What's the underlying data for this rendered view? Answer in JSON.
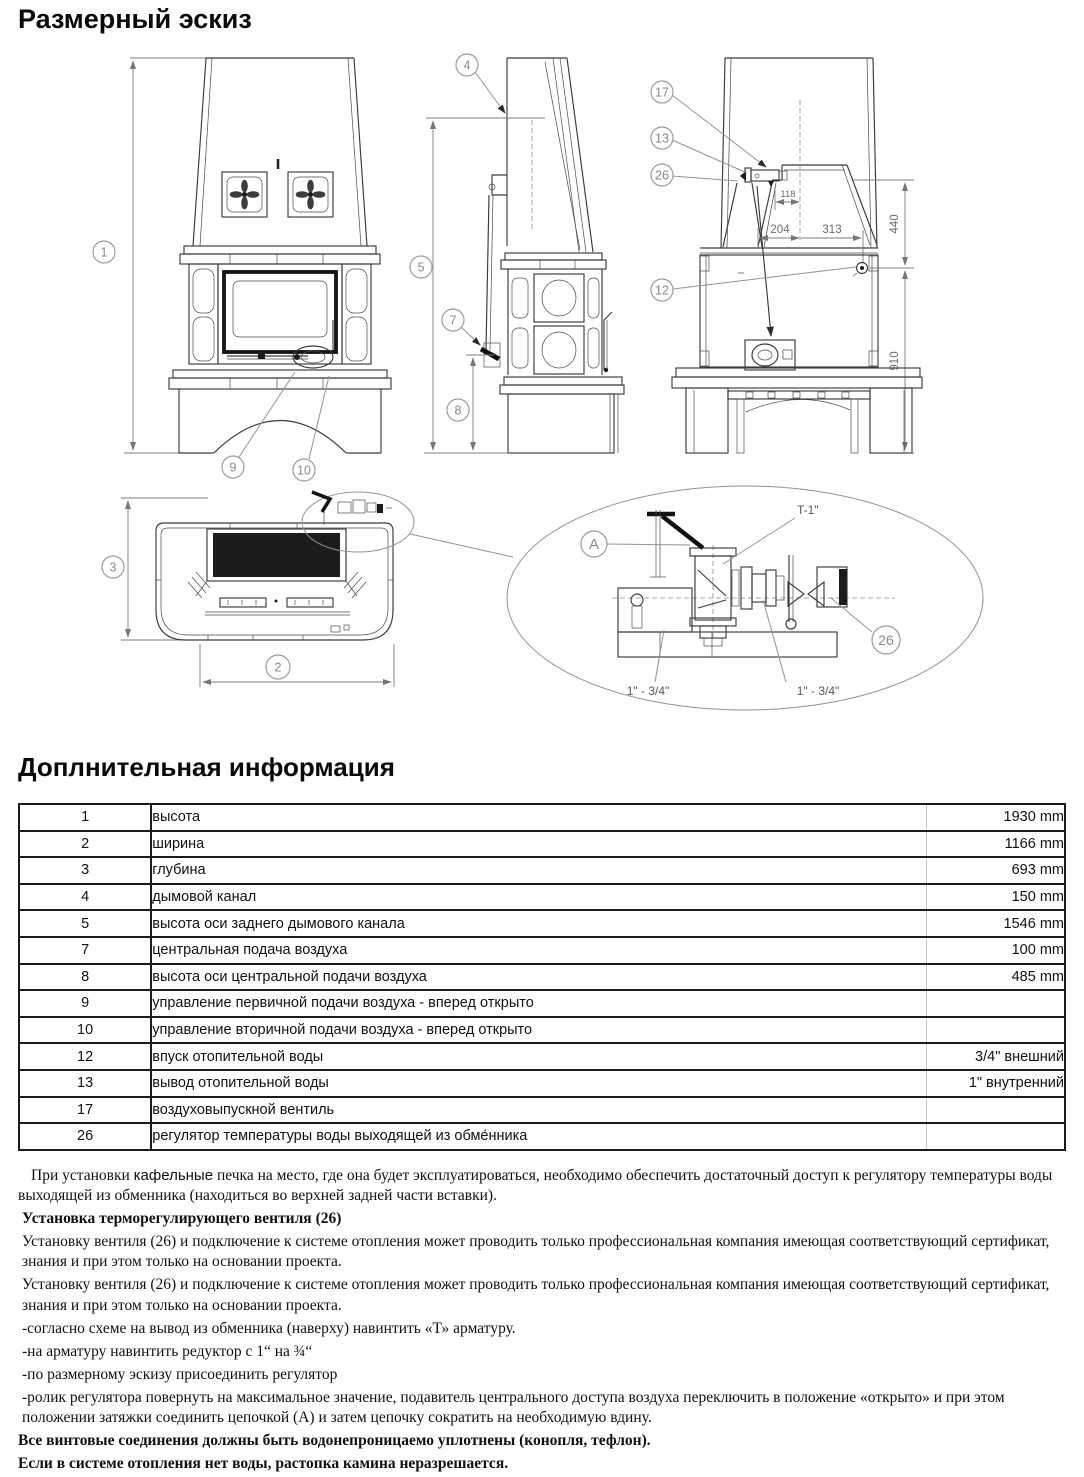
{
  "page": {
    "title": "Размерный эскиз",
    "info_title": "Доплнительная информация"
  },
  "drawing": {
    "callouts": {
      "c1": "1",
      "c2": "2",
      "c3": "3",
      "c4": "4",
      "c5": "5",
      "c7": "7",
      "c8": "8",
      "c9": "9",
      "c10": "10",
      "c12": "12",
      "c13": "13",
      "c17": "17",
      "c26_rear": "26",
      "c26_detail": "26",
      "a": "A"
    },
    "dims": {
      "d118": "118",
      "d204": "204",
      "d313": "313",
      "d440": "440",
      "d910": "910"
    },
    "detail_labels": {
      "t": "T-1\"",
      "left": "1\" - 3/4\"",
      "right": "1\" - 3/4\""
    }
  },
  "info": {
    "rows": [
      {
        "num": "1",
        "name": "высота",
        "value": "1930 mm"
      },
      {
        "num": "2",
        "name": "ширина",
        "value": "1166 mm"
      },
      {
        "num": "3",
        "name": "глубина",
        "value": "693 mm"
      },
      {
        "num": "4",
        "name": "дымовой канал",
        "value": "150 mm"
      },
      {
        "num": "5",
        "name": "высота оси заднего дымового канала",
        "value": "1546 mm"
      },
      {
        "num": "7",
        "name": "центральная подача воздуха",
        "value": "100 mm"
      },
      {
        "num": "8",
        "name": "высота оси центральной подачи воздуха",
        "value": "485 mm"
      },
      {
        "num": "9",
        "name": "управление первичной подачи воздуха - вперед открыто",
        "value": ""
      },
      {
        "num": "10",
        "name": "управление вторичной подачи воздуха - вперед открыто",
        "value": ""
      },
      {
        "num": "12",
        "name": "впуск отопительной воды",
        "value": "3/4\" внешний"
      },
      {
        "num": "13",
        "name": "вывод отопительной воды",
        "value": "1\" внутренний"
      },
      {
        "num": "17",
        "name": "воздуховыпускной вентиль",
        "value": ""
      },
      {
        "num": "26",
        "name": "регулятор температуры воды выходящей из обме́нника",
        "value": ""
      }
    ]
  },
  "notes": {
    "p1_pre": "При установки ",
    "p1_accent": "кафельные",
    "p1_post": " печка на место, где она будет эксплуатироваться, необходимо обеспечить достаточный доступ к регулятору температуры воды выходящей из обменника (находиться во верхней задней части вставки).",
    "p2": "Установка терморегулирующего вентиля (26)",
    "p3": "Установку вентиля (26) и подключение к системе отопления может проводить только профессиональная компания имеющая соответствующий сертификат, знания и при этом только на основании проекта.",
    "p4": "Установку вентиля (26) и подключение к системе отопления может проводить только профессиональная компания имеющая соответствующий сертификат, знания и при этом только на основании проекта.",
    "p5": "-согласно схеме на вывод из обменника (наверху) навинтить «Т» арматуру.",
    "p6": "-на арматуру навинтить редуктор с 1“ на ¾“",
    "p7": "-по размерному эскизу присоединить регулятор",
    "p8": "-ролик регулятора повернуть на максимальное значение, подавитель центрального доступа воздуха переключить в положение «открыто» и при этом положении затяжки соединить цепочкой (А) и затем цепочку сократить на необходимую вдину.",
    "p9": "Все винтовые соединения должны быть водонепроницаемо уплотнены (конопля, тефлон).",
    "p10": "Если в системе отопления нет воды, растопка камина неразрешается."
  }
}
